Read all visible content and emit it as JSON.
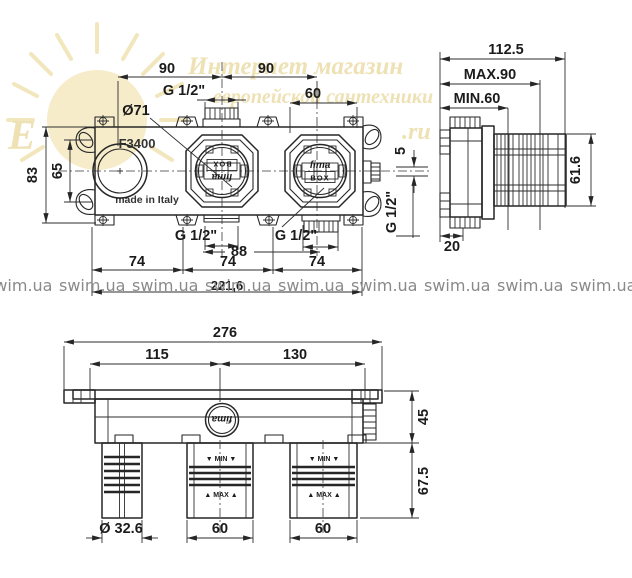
{
  "watermarks": {
    "tile": "swim.ua",
    "line1": "Интернет магазин",
    "line2": "европейской сантехники",
    "big_letter": "Е",
    "suffix": ".ru"
  },
  "front_view": {
    "model": "F3400",
    "origin": "made in Italy",
    "brand_line1": "fima",
    "brand_line2": "BOX",
    "dim_span_left": "90",
    "dim_span_right": "90",
    "dim_top_port": "G 1/2\"",
    "dim_60": "60",
    "dim_diameter": "Ø71",
    "dim_height": "83",
    "dim_slots": "65",
    "dim_offset": "5",
    "dim_side_port": "G 1/2\"",
    "dim_bottom_port_left": "G 1/2\"",
    "dim_bottom_port_right": "G 1/2\"",
    "dim_88": "88",
    "dim_74_1": "74",
    "dim_74_2": "74",
    "dim_74_3": "74",
    "dim_overall": "221,6"
  },
  "side_view": {
    "dim_depth": "112.5",
    "dim_max": "MAX.90",
    "dim_min": "MIN.60",
    "dim_height": "61.6",
    "dim_base": "20"
  },
  "bottom_view": {
    "dim_overall": "276",
    "dim_left": "115",
    "dim_right": "130",
    "dim_body": "45",
    "dim_ports": "67.5",
    "dim_spout": "Ø 32.6",
    "dim_port1": "60",
    "dim_port2": "60",
    "min_row": "▼ MIN ▼",
    "max_row": "▲ MAX ▲",
    "logo": "fima"
  }
}
